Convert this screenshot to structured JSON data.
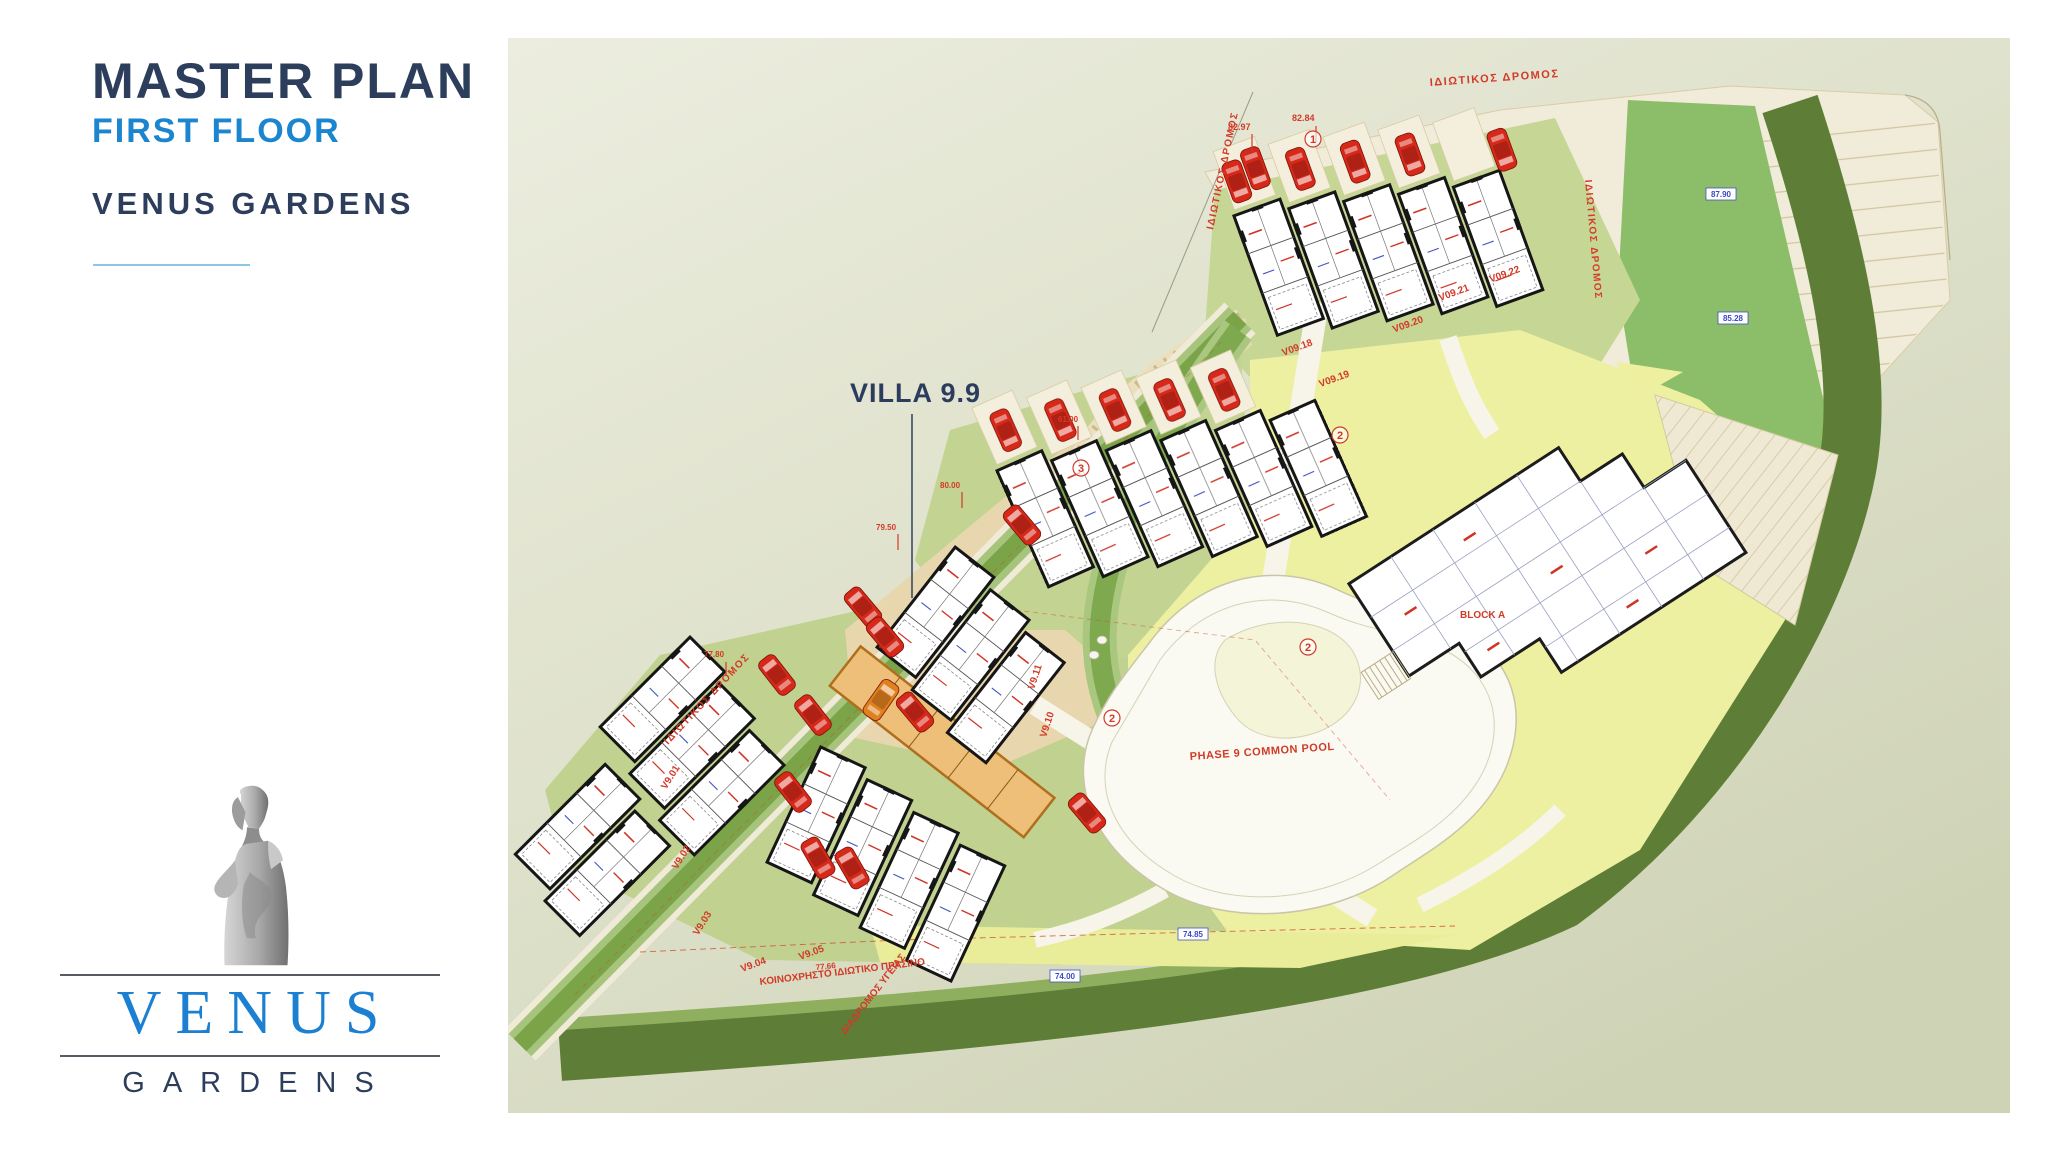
{
  "header": {
    "title": "MASTER PLAN",
    "subtitle": "FIRST FLOOR",
    "project": "VENUS GARDENS"
  },
  "logo": {
    "name": "VENUS",
    "sub": "GARDENS"
  },
  "map": {
    "callout": "VILLA 9.9",
    "pool": "PHASE 9 COMMON POOL",
    "block": "BLOCK A",
    "road": "ΙΔΙΩΤΙΚΟΣ ΔΡΟΜΟΣ",
    "green": "ΚΟΙΝΟΧΡΗΣΤΟ ΙΔΙΩΤΙΚΟ ΠΡΑΣΙΝΟ",
    "health": "ΔΙΑΔΡΟΜΟΣ ΥΓΕΙΑΣ",
    "villas_top": [
      "V09.18",
      "V09.19",
      "V09.20",
      "V09.21",
      "V09.22"
    ],
    "villas_left": [
      "V9.01",
      "V9.02",
      "V9.03",
      "V9.04",
      "V9.05"
    ],
    "villas_mid": [
      "V9.10",
      "V9.11"
    ],
    "markers": [
      "1",
      "2",
      "3"
    ],
    "dims": [
      "82.97",
      "82.84",
      "80.00",
      "79.50",
      "61.00",
      "77.80",
      "77.66"
    ],
    "elevations": [
      "87.90",
      "85.28",
      "74.85",
      "74.00"
    ]
  },
  "colors": {
    "title_navy": "#2d3e5c",
    "accent_blue": "#1b85cf",
    "underline": "#8ec6e8",
    "map_bg": "#dfe2cc",
    "road_cream": "#f1ebd9",
    "sand": "#e8d7ae",
    "grass_light": "#c3d392",
    "common_yellow": "#edf0a0",
    "green_mid": "#8cbd68",
    "green_dark": "#5e7e38",
    "car_red": "#d6291a",
    "car_orange": "#e0811f",
    "villa_orange": "#edbf79",
    "label_red": "#d23a28",
    "label_blue": "#3b49c8"
  }
}
